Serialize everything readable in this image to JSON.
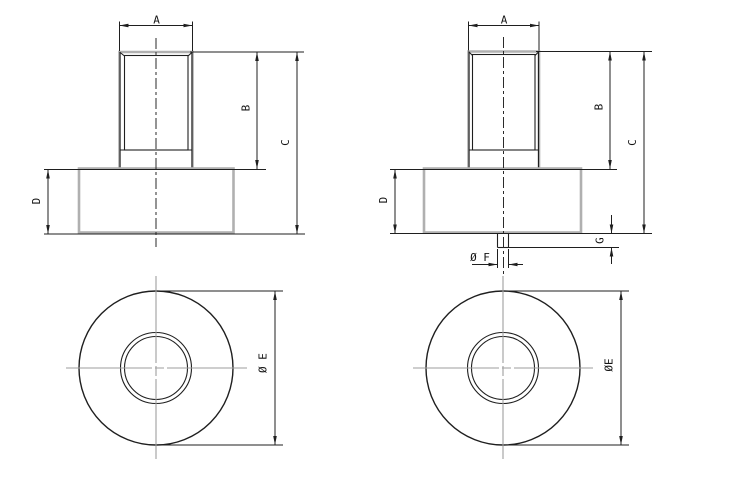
{
  "colors": {
    "background": "#ffffff",
    "line": "#1f1f1f",
    "outline": "#b0b0b0",
    "centerline": "#9e9e9e",
    "label": "#141414"
  },
  "views": {
    "front_left": {
      "dims": {
        "a": "A",
        "b": "B",
        "c": "C",
        "d": "D"
      }
    },
    "front_right": {
      "dims": {
        "a": "A",
        "b": "B",
        "c": "C",
        "d": "D",
        "g": "G",
        "f": "Ø F"
      }
    },
    "top_left": {
      "dims": {
        "e": "Ø E"
      }
    },
    "top_right": {
      "dims": {
        "e": "ØE"
      }
    }
  }
}
